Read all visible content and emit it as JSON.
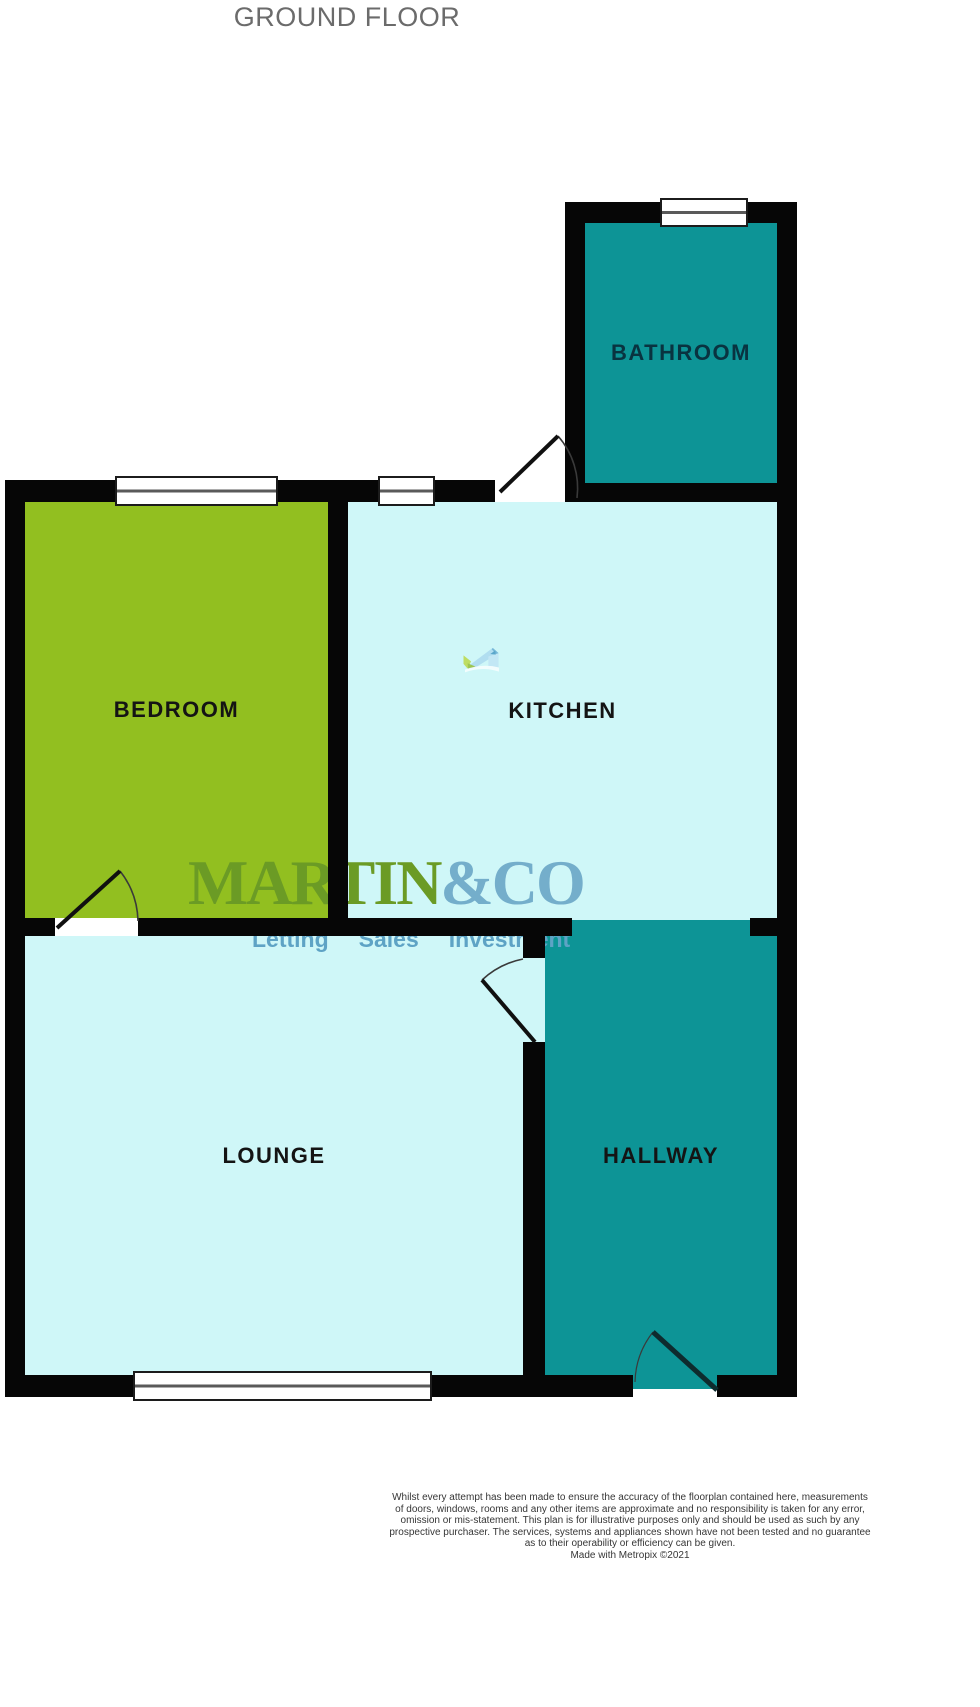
{
  "title": "GROUND FLOOR",
  "rooms": {
    "bathroom": {
      "label": "BATHROOM"
    },
    "bedroom": {
      "label": "BEDROOM"
    },
    "kitchen": {
      "label": "KITCHEN"
    },
    "lounge": {
      "label": "LOUNGE"
    },
    "hallway": {
      "label": "HALLWAY"
    }
  },
  "colors": {
    "room_teal": "#0D9496",
    "room_green": "#92BF20",
    "room_light_cyan": "#CFF7F8",
    "wall_black": "#060606",
    "title_gray": "#6B6B6B",
    "logo_green": "#6B9B25",
    "logo_blue": "#74AECB",
    "tagline_blue": "#5EA3C5"
  },
  "logo": {
    "brand_primary": "MARTIN",
    "brand_secondary": "&CO",
    "tagline": [
      "Letting",
      "Sales",
      "Investment"
    ]
  },
  "footer": {
    "disclaimer_lines": [
      "Whilst every attempt has been made to ensure the accuracy of the floorplan contained here, measurements",
      "of doors, windows, rooms and any other items are approximate and no responsibility is taken for any error,",
      "omission or mis-statement. This plan is for illustrative purposes only and should be used as such by any",
      "prospective purchaser. The services, systems and appliances shown have not been tested and no guarantee",
      "as to their operability or efficiency can be given."
    ],
    "credit": "Made with Metropix ©2021"
  }
}
